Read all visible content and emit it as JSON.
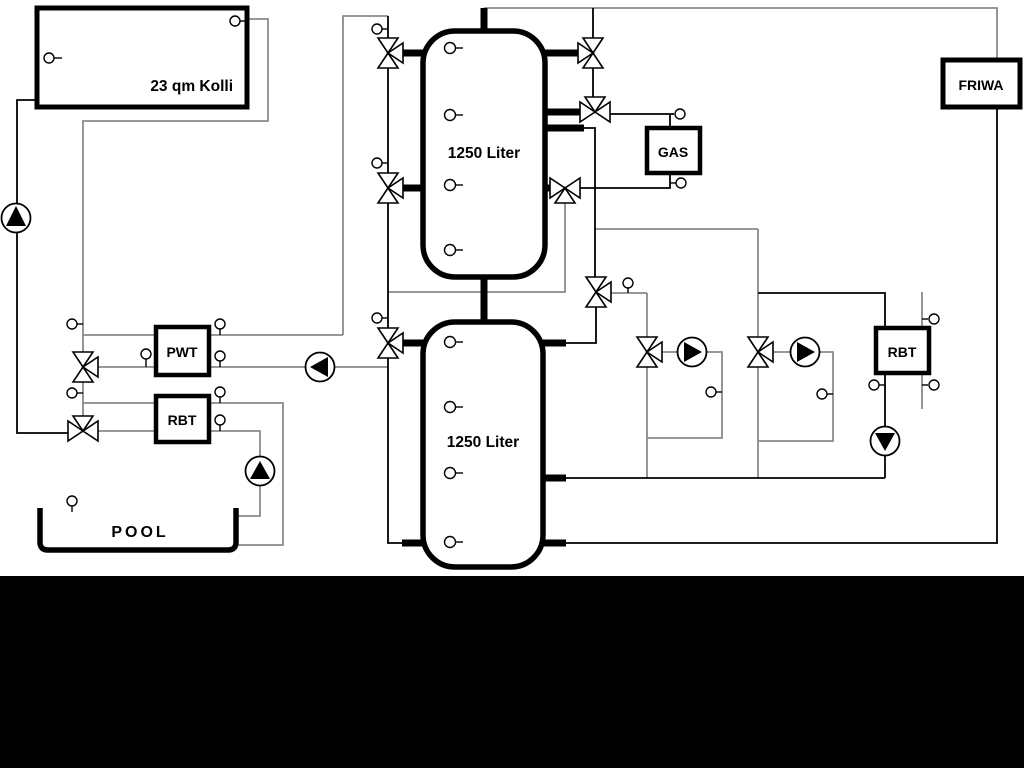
{
  "diagram": {
    "type": "hydraulic-schematic",
    "labels": {
      "collector": "23 qm Kolli",
      "tank_top": "1250 Liter",
      "tank_bottom": "1250 Liter",
      "pwt": "PWT",
      "rbt_left": "RBT",
      "rbt_right": "RBT",
      "gas": "GAS",
      "friwa": "FRIWA",
      "pool": "POOL"
    },
    "colors": {
      "background": "#ffffff",
      "pipe_black": "#000000",
      "pipe_gray": "#8a8a8a",
      "footer_band": "#000000",
      "component_fill": "#ffffff"
    }
  }
}
